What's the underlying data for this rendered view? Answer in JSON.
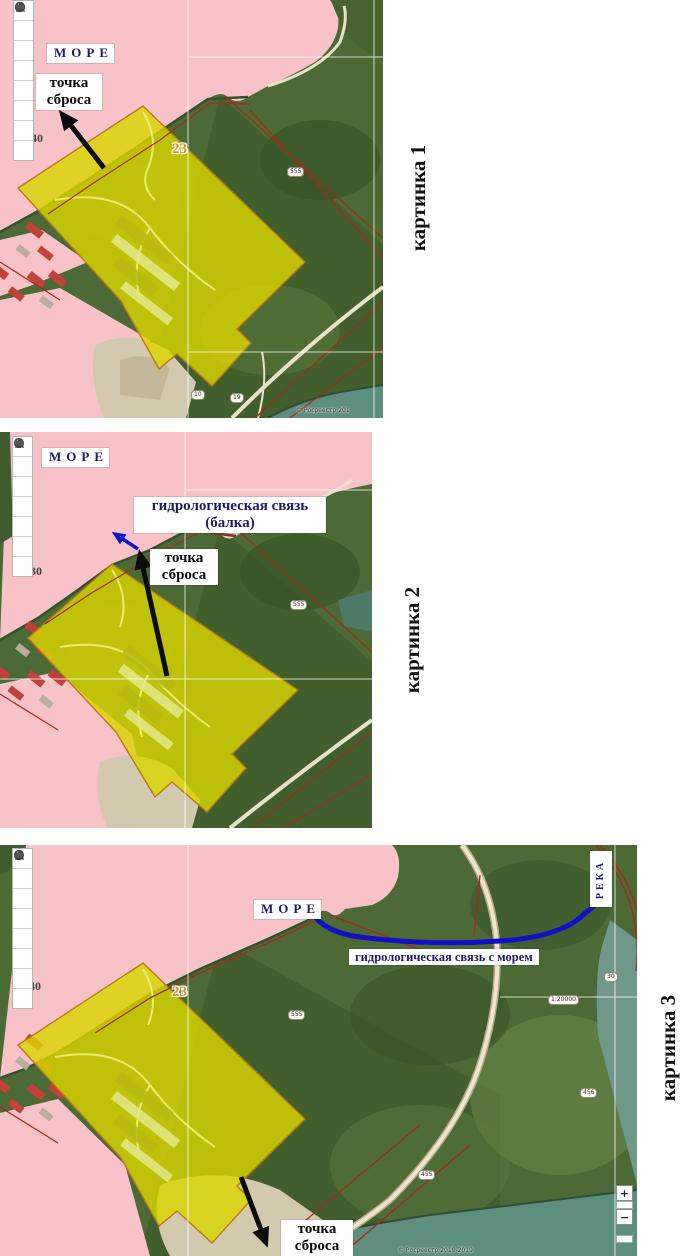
{
  "colors": {
    "sea_pink": "#f7c3c8",
    "annotation_blue": "#1212cc",
    "label_navy": "#1c1c66",
    "parcel_yellow": "#d9d600",
    "water_teal": "#5d8e7e",
    "parcel_number_orange": "#d4951f"
  },
  "toolbar_tools": [
    "info",
    "search",
    "pencil",
    "highlighter",
    "star",
    "printer",
    "history",
    "card"
  ],
  "figures": [
    {
      "caption": "картинка 1",
      "labels": {
        "sea": "МОРЕ",
        "discharge_line1": "точка",
        "discharge_line2": "сброса",
        "parcel_number": "23",
        "coord_label": "40",
        "parcel_oval_1": "555",
        "parcel_oval_2": "10",
        "parcel_oval_3": "19",
        "copyright": "© Росреестр 201"
      }
    },
    {
      "caption": "картинка 2",
      "labels": {
        "sea": "МОРЕ",
        "hydro_line1": "гидрологическая связь",
        "hydro_line2": "(балка)",
        "discharge_line1": "точка",
        "discharge_line2": "сброса",
        "coord_label": "30",
        "parcel_oval_1": "555"
      }
    },
    {
      "caption": "картинка 3",
      "labels": {
        "sea": "МОРЕ",
        "hydro": "гидрологическая связь с морем",
        "river": "РЕКА",
        "discharge_line1": "точка",
        "discharge_line2": "сброса",
        "parcel_number": "23",
        "coord_label": "40",
        "coord_label_2": "30",
        "scale": "1:20000",
        "parcel_oval_1": "555",
        "parcel_oval_2": "456",
        "parcel_oval_3": "455",
        "copyright": "© Росреестр 2010-2019"
      },
      "zoom_control": {
        "zoom_in": "+",
        "zoom_out": "−"
      }
    }
  ]
}
